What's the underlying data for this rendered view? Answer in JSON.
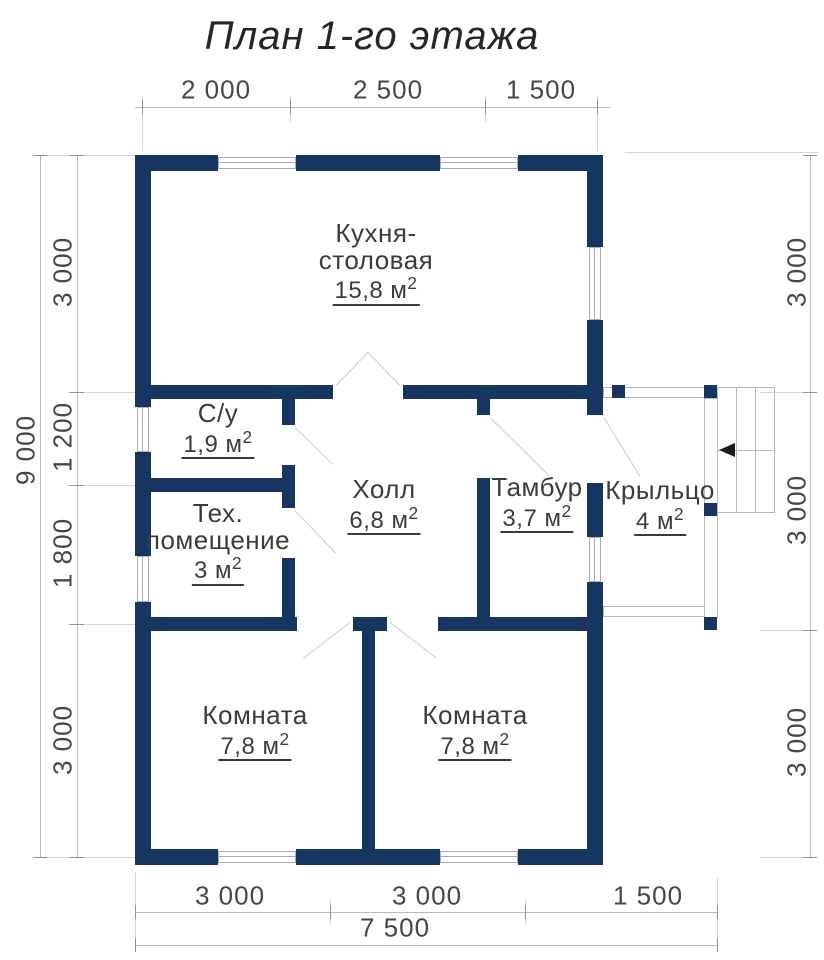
{
  "title": "План 1-го этажа",
  "colors": {
    "wall": "#163561",
    "thin_line": "#b6bac0",
    "text": "#3c3c3c"
  },
  "rooms": [
    {
      "name": "Кухня-",
      "name2": "столовая",
      "area": "15,8 м",
      "sup": "2"
    },
    {
      "name": "С/у",
      "area": "1,9 м",
      "sup": "2"
    },
    {
      "name": "Тех.",
      "name2": "помещение",
      "area": "3 м",
      "sup": "2"
    },
    {
      "name": "Холл",
      "area": "6,8 м",
      "sup": "2"
    },
    {
      "name": "Тамбур",
      "area": "3,7 м",
      "sup": "2"
    },
    {
      "name": "Крыльцо",
      "area": "4 м",
      "sup": "2"
    },
    {
      "name": "Комната",
      "area": "7,8 м",
      "sup": "2"
    },
    {
      "name": "Комната",
      "area": "7,8 м",
      "sup": "2"
    }
  ],
  "dimensions": {
    "top": [
      "2 000",
      "2 500",
      "1 500"
    ],
    "left_segments": [
      "3 000",
      "1 200",
      "1 800",
      "3 000"
    ],
    "left_total": "9 000",
    "right_segments": [
      "3 000",
      "3 000",
      "3 000"
    ],
    "bottom_segments": [
      "3 000",
      "3 000",
      "1 500"
    ],
    "bottom_total": "7 500"
  }
}
